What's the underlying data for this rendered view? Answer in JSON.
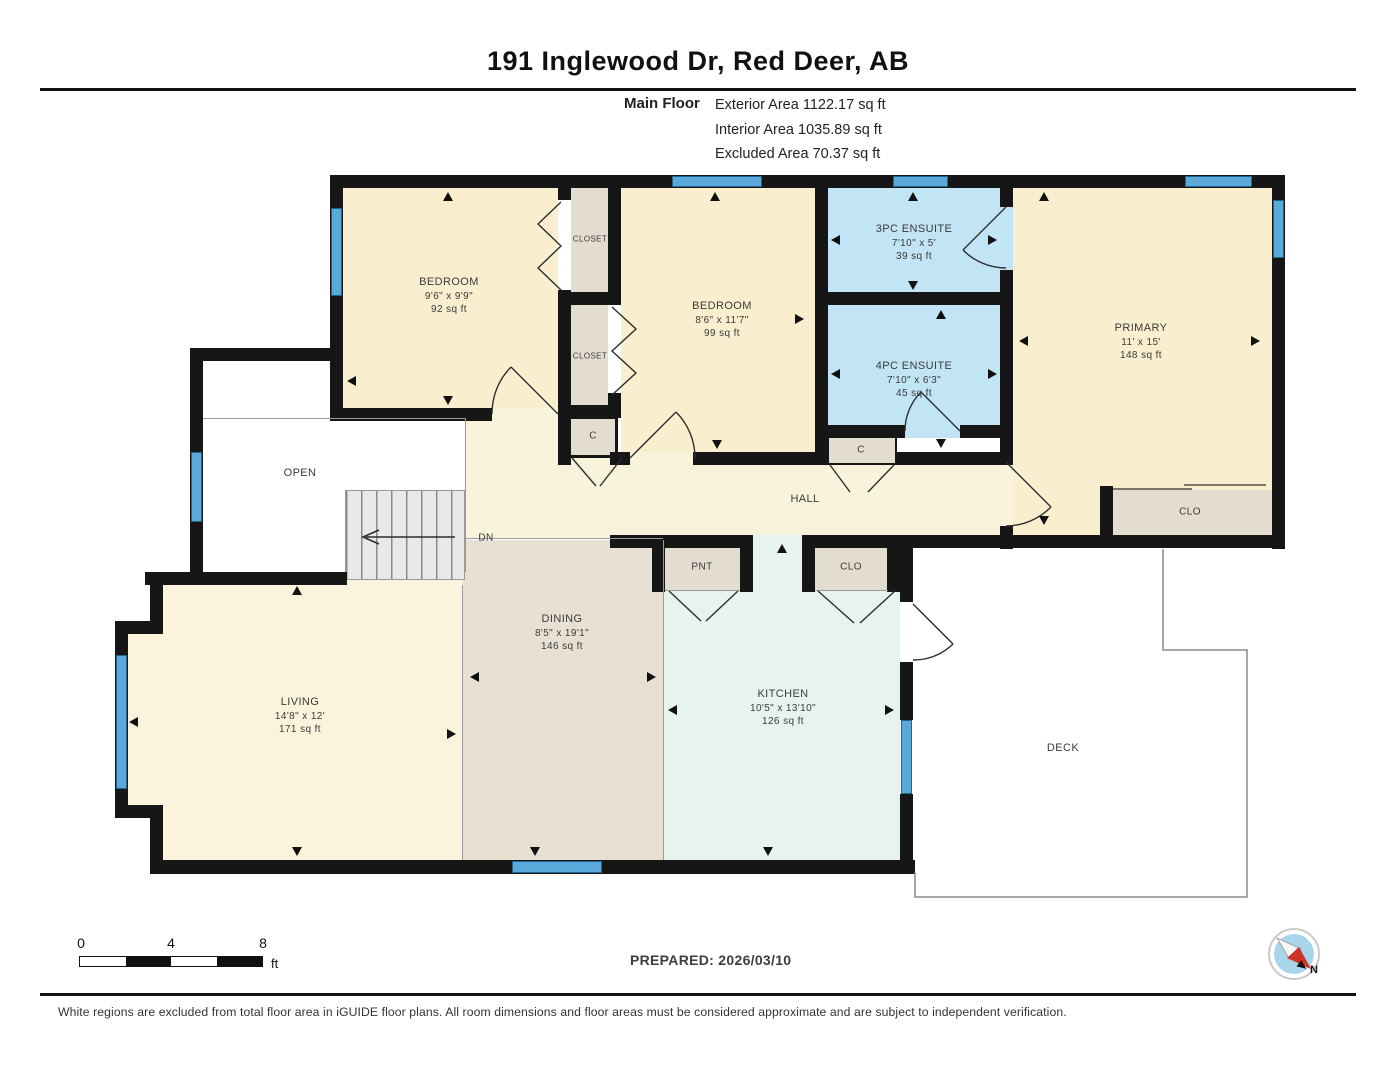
{
  "header": {
    "title": "191 Inglewood Dr, Red Deer, AB",
    "floor_label": "Main Floor",
    "area_lines": {
      "exterior": "Exterior Area 1122.17 sq ft",
      "interior": "Interior Area 1035.89 sq ft",
      "excluded": "Excluded Area 70.37 sq ft"
    }
  },
  "rooms": {
    "bedroom1": {
      "name": "BEDROOM",
      "dims": "9'6\" x 9'9\"",
      "area": "92 sq ft"
    },
    "bedroom2": {
      "name": "BEDROOM",
      "dims": "8'6\" x 11'7\"",
      "area": "99 sq ft"
    },
    "ensuite3": {
      "name": "3PC ENSUITE",
      "dims": "7'10\" x 5'",
      "area": "39 sq ft"
    },
    "ensuite4": {
      "name": "4PC ENSUITE",
      "dims": "7'10\" x 6'3\"",
      "area": "45 sq ft"
    },
    "primary": {
      "name": "PRIMARY",
      "dims": "11' x 15'",
      "area": "148 sq ft"
    },
    "living": {
      "name": "LIVING",
      "dims": "14'8\" x 12'",
      "area": "171 sq ft"
    },
    "dining": {
      "name": "DINING",
      "dims": "8'5\" x 19'1\"",
      "area": "146 sq ft"
    },
    "kitchen": {
      "name": "KITCHEN",
      "dims": "10'5\" x 13'10\"",
      "area": "126 sq ft"
    }
  },
  "labels": {
    "hall": "HALL",
    "open": "OPEN",
    "deck": "DECK",
    "closet_upper": "CLOSET",
    "closet_lower": "CLOSET",
    "primary_closet": "CLO",
    "hall_closet": "CLO",
    "pantry": "PNT",
    "small_closet_a": "C",
    "small_closet_b": "C",
    "stairs_down": "DN"
  },
  "scale_bar": {
    "ticks": [
      "0",
      "4",
      "8"
    ],
    "unit": "ft"
  },
  "footer": {
    "prepared": "PREPARED: 2026/03/10",
    "disclaimer": "White regions are excluded from total floor area in iGUIDE floor plans. All room dimensions and floor areas must be considered approximate and are subject to independent verification.",
    "compass_north": "N"
  },
  "icons": {
    "compass": "compass-icon",
    "direction_arrow": "direction-arrow-icon",
    "door_swing": "door-swing-icon"
  },
  "colors": {
    "wall": "#161616",
    "window": "#59a9da",
    "room_cream": "#f9efcf",
    "room_hall": "#faf3dc",
    "room_blue": "#c2e5f6",
    "room_taupe": "#e8e0d3",
    "room_mint": "#e6f3ee",
    "room_yellow": "#fbf3dc",
    "closet_gray": "#e3ddd0",
    "compass_red": "#cf3327"
  }
}
